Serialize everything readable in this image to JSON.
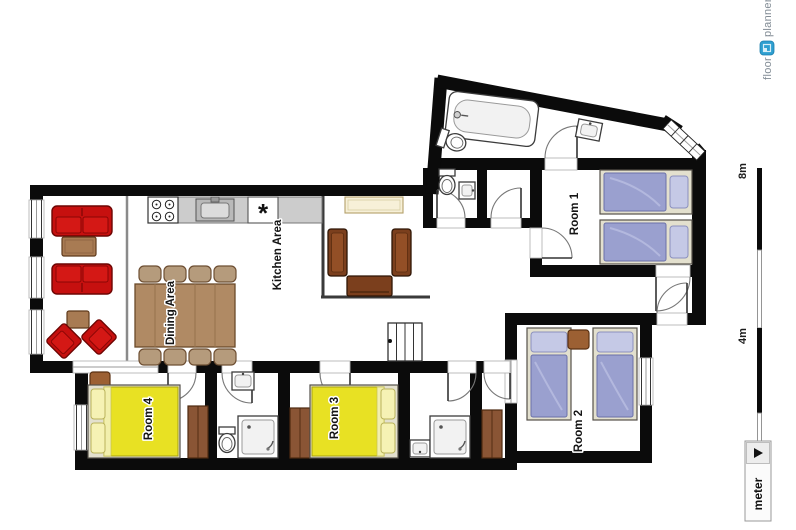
{
  "labels": {
    "kitchen": "Kitchen Area",
    "dining": "Dining Area",
    "room1": "Room 1",
    "room2": "Room 2",
    "room3": "Room 3",
    "room4": "Room 4"
  },
  "scale_bar": {
    "top_label": "8m",
    "mid_label": "4m",
    "unit_selector": "meter"
  },
  "logo": {
    "word1": "floor",
    "word2": "planner"
  },
  "symbols": {
    "dishwasher": "*"
  },
  "palette": {
    "wall": "#0b0b0b",
    "sofa": "#c6100f",
    "sofa_cushion": "#d41815",
    "wood": "#a87b53",
    "wood_dark": "#7b3f1d",
    "table_wood": "#b08a64",
    "chair_tan": "#b59b7c",
    "wardrobe": "#8a5535",
    "nightstand": "#9c6033",
    "bed_yellow": "#e8e123",
    "pillow_yellow": "#f6f2b4",
    "bed_blue": "#9aa0cf",
    "pillow_blue": "#c5c9e6",
    "bed_frame": "#e3e0ce",
    "counter": "#cccccc",
    "sideboard": "#f7f0d8",
    "logo_blue": "#2e9fd0"
  }
}
